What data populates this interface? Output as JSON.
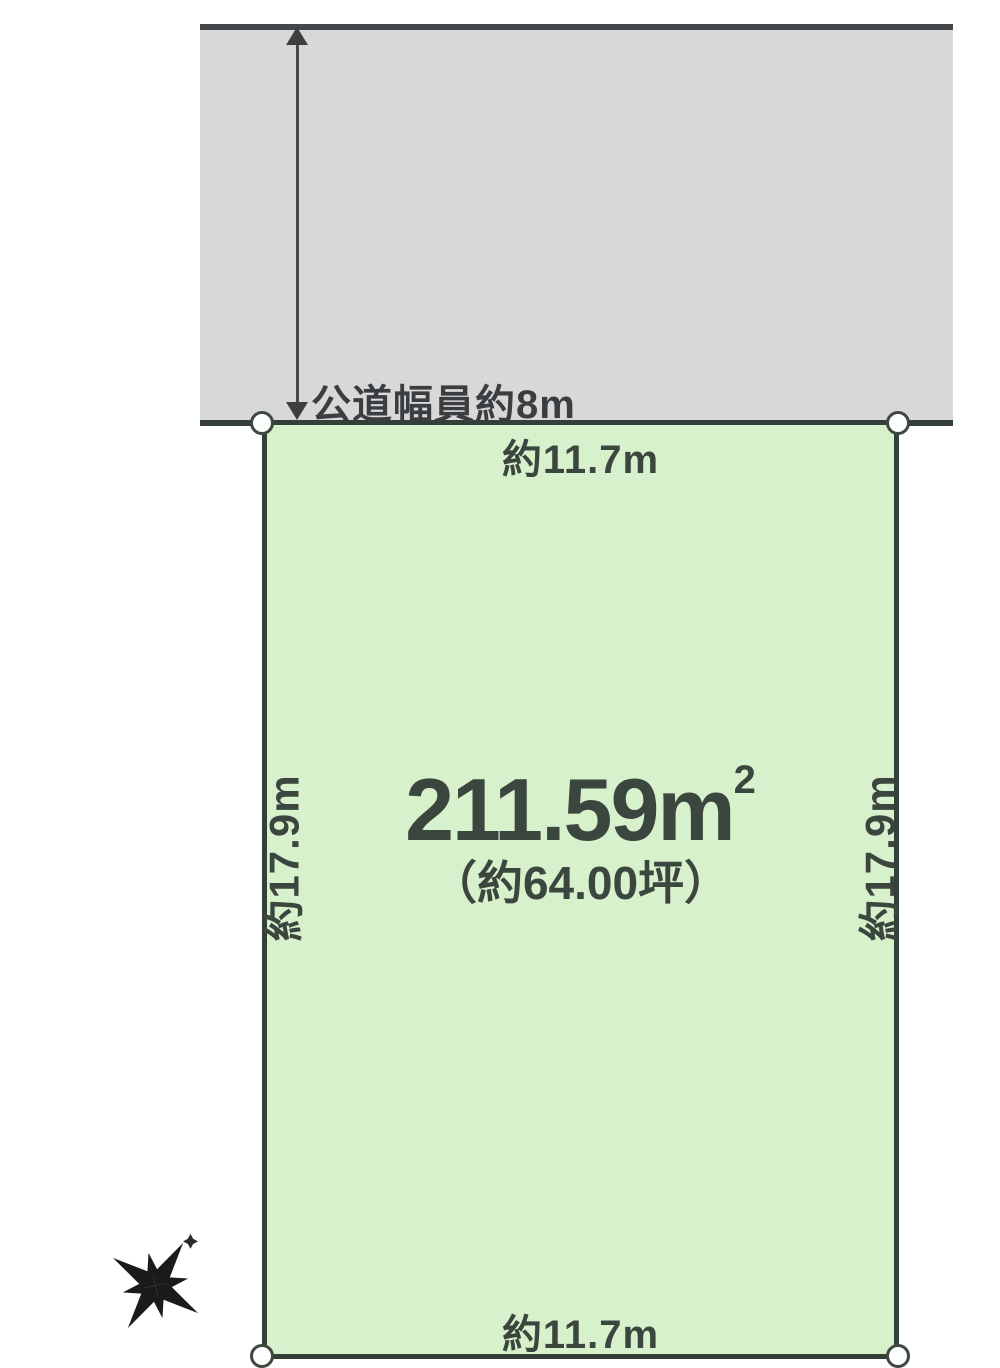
{
  "diagram": {
    "title": "land-plot-layout",
    "road": {
      "label": "公道幅員約8m",
      "fill": "#d9d8d9",
      "edge_color": "#45484b"
    },
    "plot": {
      "fill": "#d8f1cd",
      "border_color": "#333f37",
      "top_width_label": "約11.7m",
      "bottom_width_label": "約11.7m",
      "left_depth_label": "約17.9m",
      "right_depth_label": "約17.9m",
      "area_sqm_value": "211.59",
      "area_sqm_unit": "m",
      "area_sqm_superscript": "2",
      "area_tsubo_label": "（約64.00坪）"
    },
    "annotations": {
      "road_width_arrow": "double-headed-vertical-arrow",
      "corner_markers": "white-circle"
    },
    "compass": {
      "icon": "compass-rose-icon",
      "north_marker": "sparkle-star",
      "color": "#1b1b1b"
    },
    "text_color": "#3b463e"
  }
}
